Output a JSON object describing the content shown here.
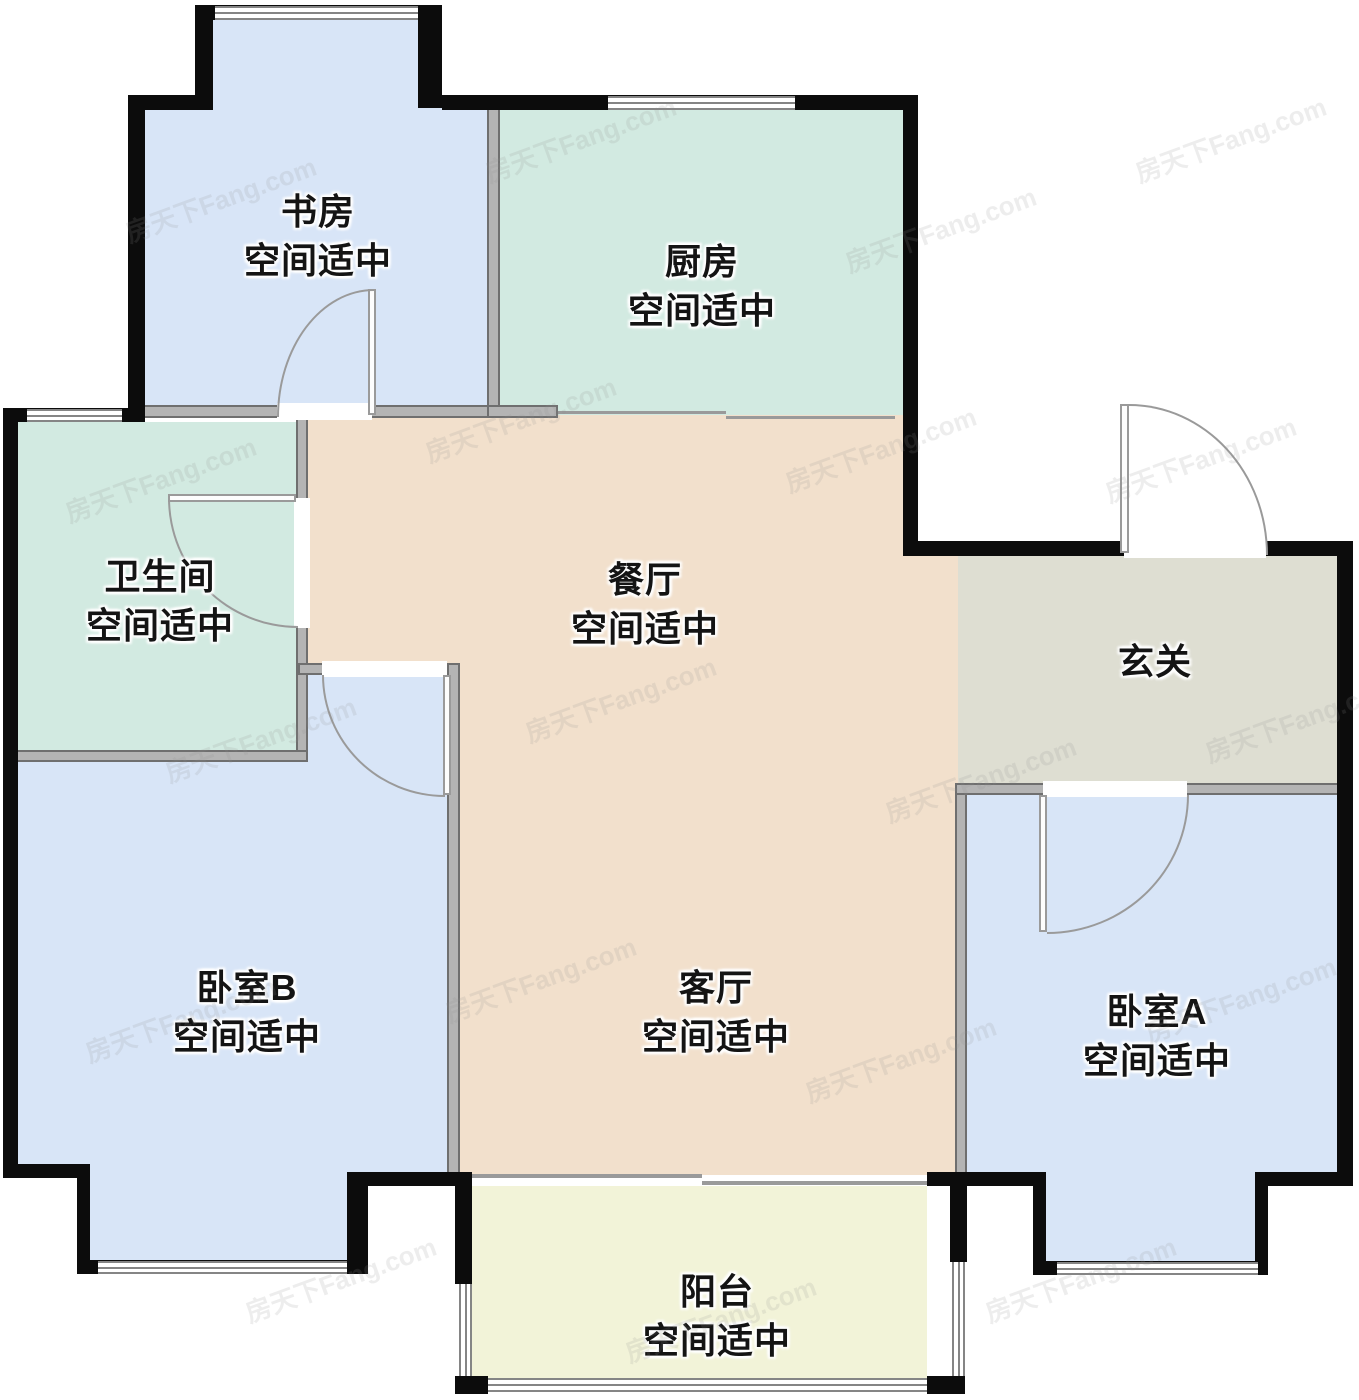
{
  "watermark": {
    "text": "房天下Fang.com"
  },
  "rooms": {
    "study": {
      "name": "书房",
      "note": "空间适中"
    },
    "kitchen": {
      "name": "厨房",
      "note": "空间适中"
    },
    "bathroom": {
      "name": "卫生间",
      "note": "空间适中"
    },
    "dining": {
      "name": "餐厅",
      "note": "空间适中"
    },
    "hallway": {
      "name": "玄关"
    },
    "bedroom_b": {
      "name": "卧室B",
      "note": "空间适中"
    },
    "living": {
      "name": "客厅",
      "note": "空间适中"
    },
    "bedroom_a": {
      "name": "卧室A",
      "note": "空间适中"
    },
    "balcony": {
      "name": "阳台",
      "note": "空间适中"
    }
  },
  "colors": {
    "exterior_wall": "#0c0c0c",
    "interior_wall": "#b4b4b4",
    "bedroom_fill": "#d8e5f7",
    "kitchen_bath_fill": "#d2eae1",
    "dining_living_fill": "#f2e0cc",
    "hallway_fill": "#deded2",
    "balcony_fill": "#f2f3d8",
    "door_line": "#9a9a9a",
    "window_line": "#858585"
  }
}
